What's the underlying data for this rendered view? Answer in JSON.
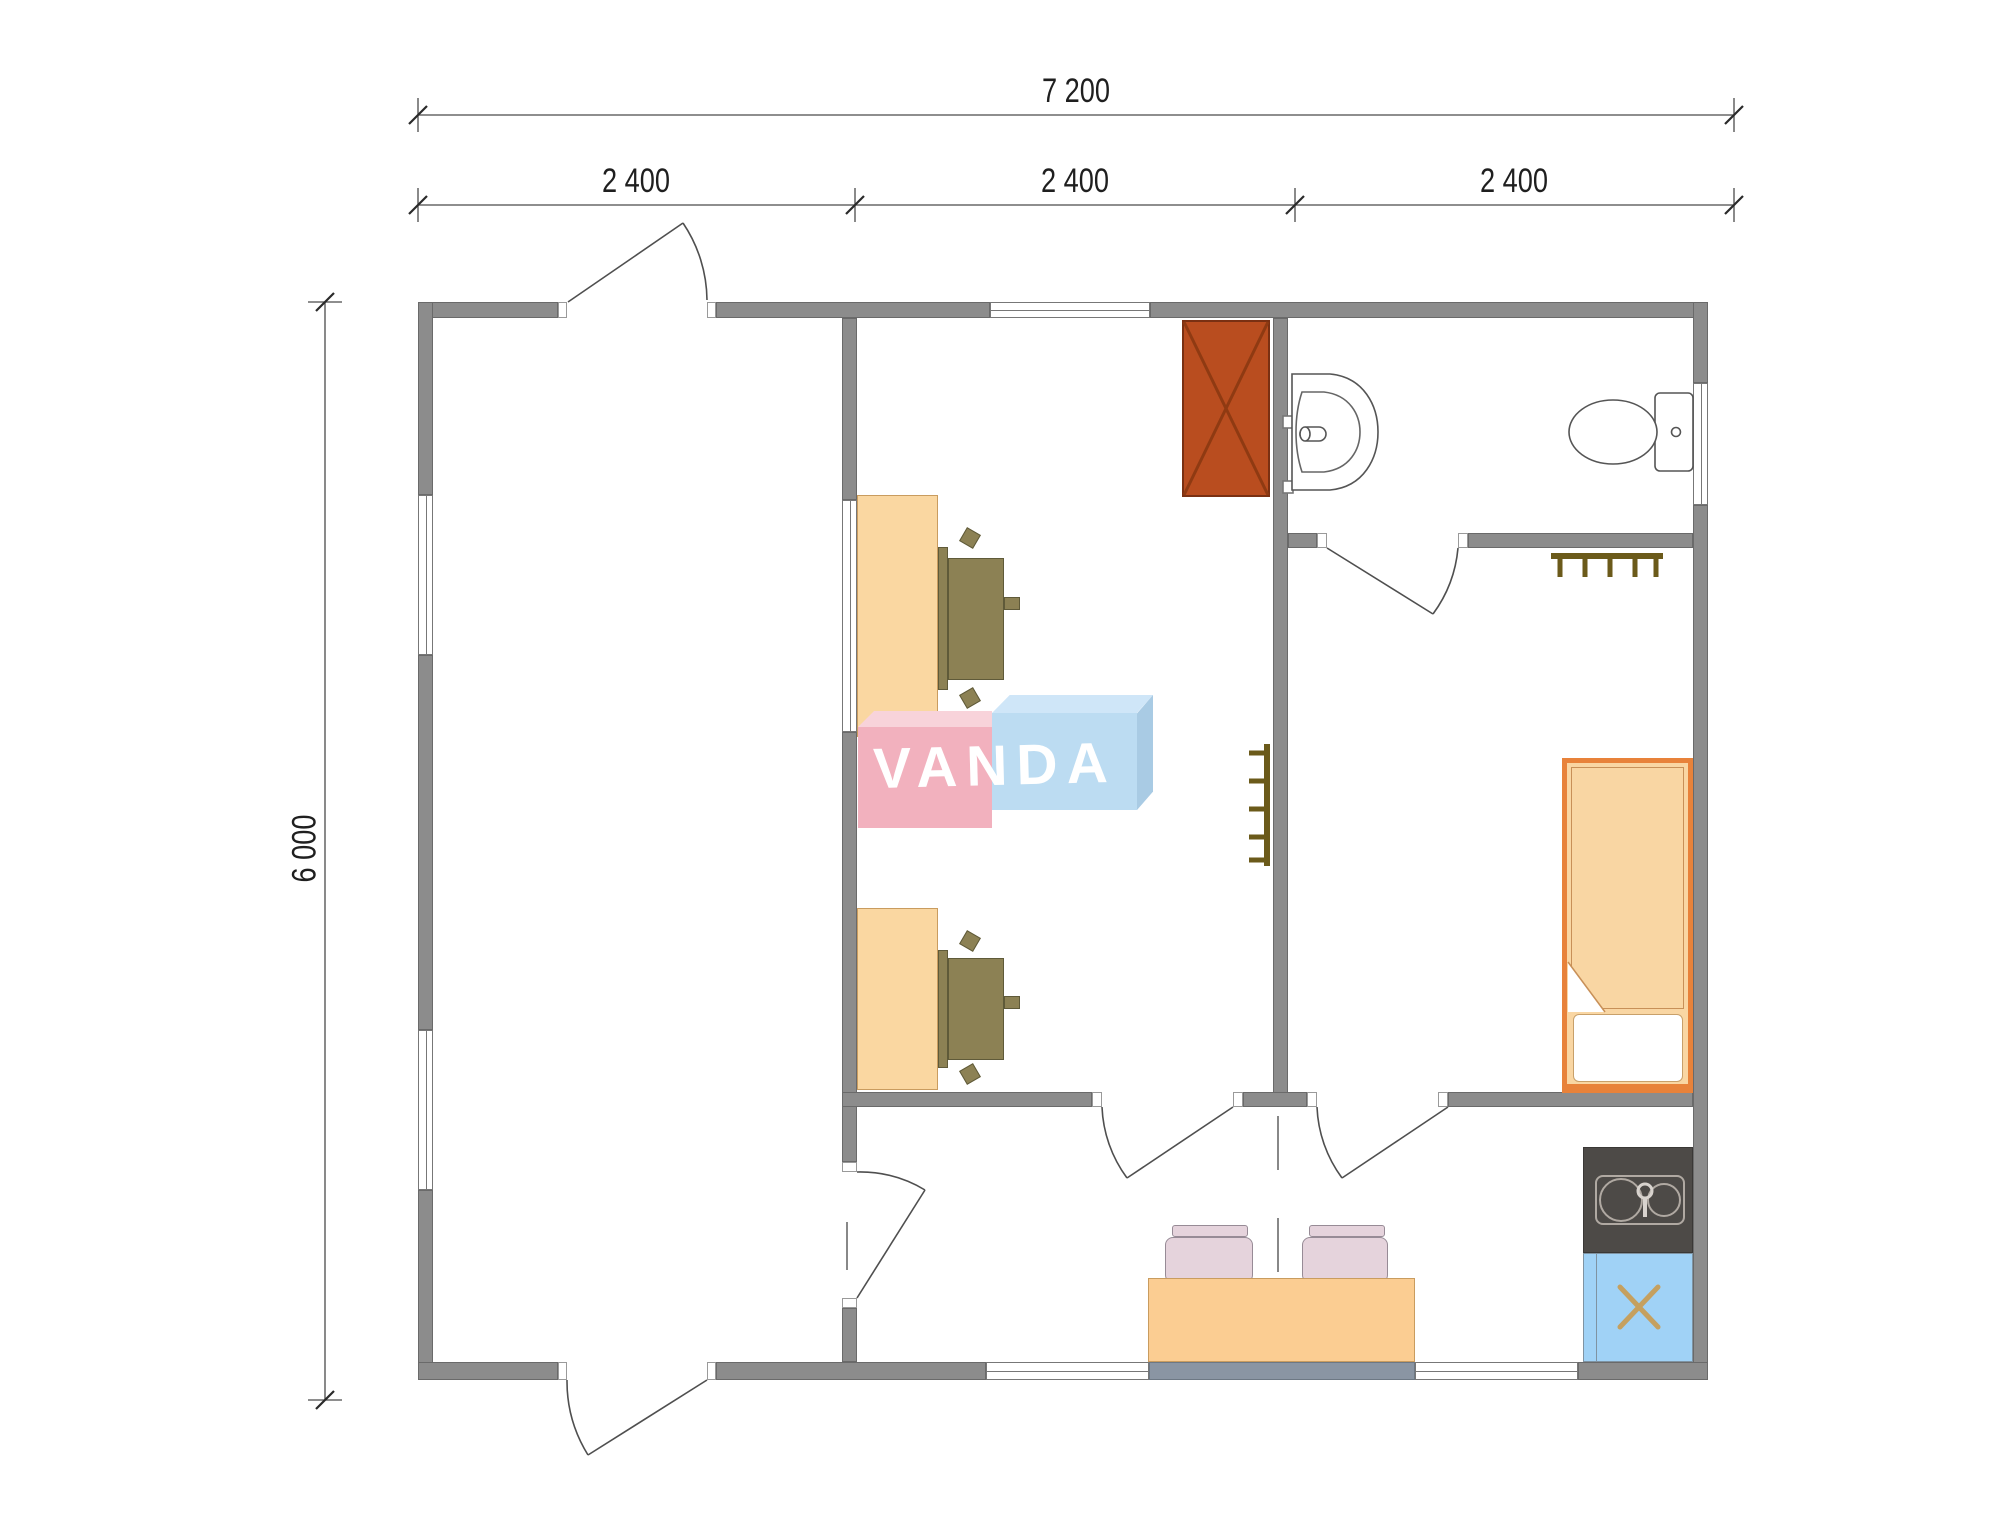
{
  "dimensions": {
    "total_width": "7 200",
    "width_segments": [
      "2 400",
      "2 400",
      "2 400"
    ],
    "total_height": "6 000"
  },
  "watermark": {
    "text": "VANDA"
  },
  "palette": {
    "wall": "#8C8C8C",
    "wall_edge": "#6A6A6A",
    "glass_panel": "#8A95A3",
    "wood_light": "#FAD7A1",
    "office_chair": "#8C8154",
    "wardrobe": "#B94D1F",
    "wardrobe_cross": "#8F3A12",
    "bed_frame": "#E8823A",
    "bed_fill": "#F9D6A3",
    "dining_chair": "#E5D3DC",
    "kitchen_counter": "#4D4A47",
    "kitchen_cabinet": "#A0D2F6",
    "hob_symbol": "#C5A05F",
    "radiator": "#6B5A1A",
    "logo_pink": "#F2B1BE",
    "logo_blue": "#BCDCF2",
    "dimension_text": "#1F1F1F"
  }
}
